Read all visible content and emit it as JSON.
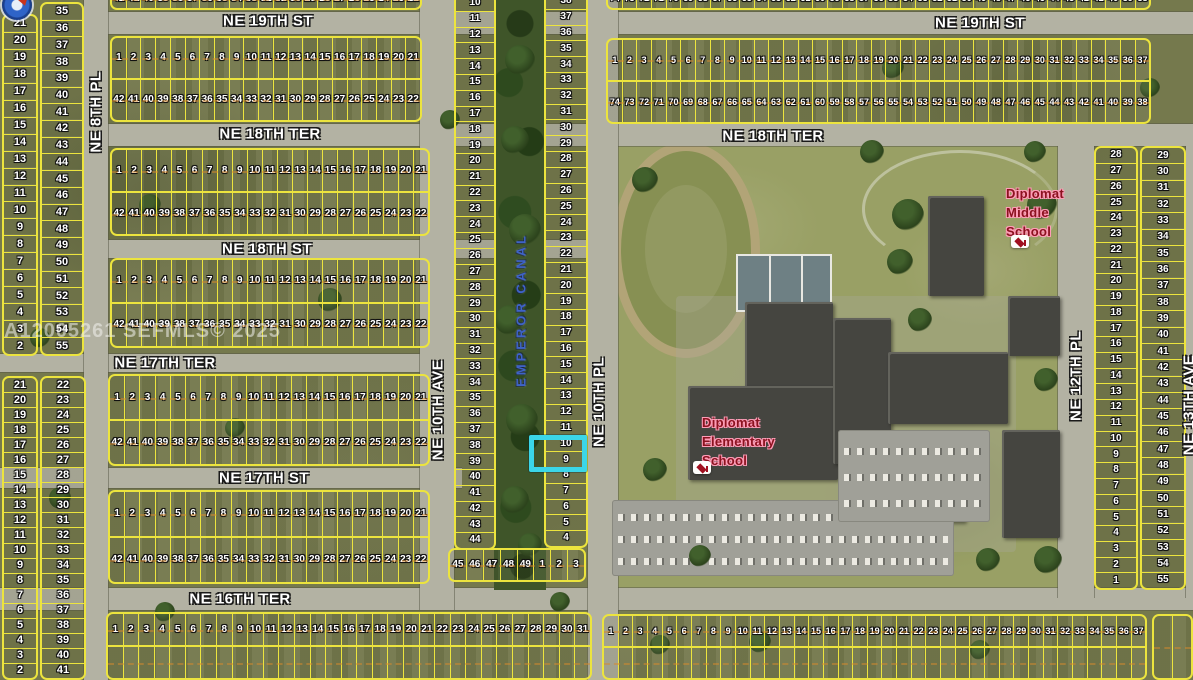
{
  "watermark": "A12005261 SEFMLS© 2025",
  "canal_label": "EMPEROR CANAL",
  "colors": {
    "line": "#ece43e",
    "hl": "#3bd6e8",
    "schoolred": "#8c1220",
    "schoolglow": "#ff9db8",
    "canalblue": "#3e63c8",
    "wm": "rgba(242,242,238,0.55)",
    "road": "#b3b2a3"
  },
  "schools": {
    "elementary": {
      "lines": [
        "Diplomat",
        "Elementary",
        "School"
      ]
    },
    "middle": {
      "lines": [
        "Diplomat",
        "Middle",
        "School"
      ]
    }
  },
  "roads": [
    {
      "id": "ne-19th-st",
      "x": 84,
      "y": 12,
      "w": 1109,
      "h": 22
    },
    {
      "id": "ne-18th-ter",
      "x": 108,
      "y": 124,
      "w": 1085,
      "h": 22
    },
    {
      "id": "ne-18th-st",
      "x": 108,
      "y": 240,
      "w": 510,
      "h": 18
    },
    {
      "id": "ne-17th-ter",
      "x": 0,
      "y": 354,
      "w": 454,
      "h": 18
    },
    {
      "id": "ne-17th-st",
      "x": 0,
      "y": 468,
      "w": 462,
      "h": 20
    },
    {
      "id": "ne-16th-ter",
      "x": 0,
      "y": 588,
      "w": 1193,
      "h": 22
    },
    {
      "id": "ne-8th-pl",
      "x": 84,
      "y": 0,
      "w": 24,
      "h": 680
    },
    {
      "id": "ne-10th-ave",
      "x": 420,
      "y": 0,
      "w": 34,
      "h": 610
    },
    {
      "id": "ne-10th-pl",
      "x": 588,
      "y": 0,
      "w": 30,
      "h": 680
    },
    {
      "id": "ne-12th-pl",
      "x": 1058,
      "y": 146,
      "w": 36,
      "h": 452
    },
    {
      "id": "ne-13th-ave",
      "x": 1186,
      "y": 146,
      "w": 7,
      "h": 452
    }
  ],
  "street_labels": [
    {
      "id": "ne-19th-st-west",
      "text": "NE 19TH ST",
      "x": 268,
      "y": 21,
      "vertical": false
    },
    {
      "id": "ne-19th-st-east",
      "text": "NE 19TH ST",
      "x": 980,
      "y": 23,
      "vertical": false
    },
    {
      "id": "ne-18th-ter-west",
      "text": "NE 18TH TER",
      "x": 270,
      "y": 134,
      "vertical": false
    },
    {
      "id": "ne-18th-ter-east",
      "text": "NE 18TH TER",
      "x": 773,
      "y": 136,
      "vertical": false
    },
    {
      "id": "ne-18th-st",
      "text": "NE 18TH ST",
      "x": 267,
      "y": 249,
      "vertical": false
    },
    {
      "id": "ne-17th-ter",
      "text": "NE 17TH TER",
      "x": 165,
      "y": 363,
      "vertical": false
    },
    {
      "id": "ne-17th-st",
      "text": "NE 17TH ST",
      "x": 264,
      "y": 478,
      "vertical": false
    },
    {
      "id": "ne-16th-ter",
      "text": "NE 16TH TER",
      "x": 240,
      "y": 599,
      "vertical": false
    },
    {
      "id": "ne-8th-pl",
      "text": "NE 8TH PL",
      "x": 96,
      "y": 112,
      "vertical": true
    },
    {
      "id": "ne-10th-ave",
      "text": "NE 10TH AVE",
      "x": 438,
      "y": 410,
      "vertical": true
    },
    {
      "id": "ne-10th-pl",
      "text": "NE 10TH PL",
      "x": 599,
      "y": 402,
      "vertical": true
    },
    {
      "id": "ne-12th-pl",
      "text": "NE 12TH PL",
      "x": 1076,
      "y": 376,
      "vertical": true
    },
    {
      "id": "ne-13th-ave",
      "text": "NE 13TH AVE",
      "x": 1189,
      "y": 405,
      "vertical": true
    }
  ],
  "sequences": {
    "asc1_21": [
      1,
      2,
      3,
      4,
      5,
      6,
      7,
      8,
      9,
      10,
      11,
      12,
      13,
      14,
      15,
      16,
      17,
      18,
      19,
      20,
      21
    ],
    "desc42_22": [
      42,
      41,
      40,
      39,
      38,
      37,
      36,
      35,
      34,
      33,
      32,
      31,
      30,
      29,
      28,
      27,
      26,
      25,
      24,
      23,
      22
    ],
    "desc21_2": [
      21,
      20,
      19,
      18,
      17,
      16,
      15,
      14,
      13,
      12,
      11,
      10,
      9,
      8,
      7,
      6,
      5,
      4,
      3,
      2
    ],
    "asc35_55": [
      35,
      36,
      37,
      38,
      39,
      40,
      41,
      42,
      43,
      44,
      45,
      46,
      47,
      48,
      49,
      50,
      51,
      52,
      53,
      54,
      55
    ],
    "asc22_41": [
      22,
      23,
      24,
      25,
      26,
      27,
      28,
      29,
      30,
      31,
      32,
      33,
      34,
      35,
      36,
      37,
      38,
      39,
      40,
      41
    ],
    "asc1_37": [
      1,
      2,
      3,
      4,
      5,
      6,
      7,
      8,
      9,
      10,
      11,
      12,
      13,
      14,
      15,
      16,
      17,
      18,
      19,
      20,
      21,
      22,
      23,
      24,
      25,
      26,
      27,
      28,
      29,
      30,
      31,
      32,
      33,
      34,
      35,
      36,
      37
    ],
    "desc74_38": [
      74,
      73,
      72,
      71,
      70,
      69,
      68,
      67,
      66,
      65,
      64,
      63,
      62,
      61,
      60,
      59,
      58,
      57,
      56,
      55,
      54,
      53,
      52,
      51,
      50,
      49,
      48,
      47,
      46,
      45,
      44,
      43,
      42,
      41,
      40,
      39,
      38
    ],
    "asc1_31": [
      1,
      2,
      3,
      4,
      5,
      6,
      7,
      8,
      9,
      10,
      11,
      12,
      13,
      14,
      15,
      16,
      17,
      18,
      19,
      20,
      21,
      22,
      23,
      24,
      25,
      26,
      27,
      28,
      29,
      30,
      31
    ],
    "desc28_1": [
      28,
      27,
      26,
      25,
      24,
      23,
      22,
      21,
      20,
      19,
      18,
      17,
      16,
      15,
      14,
      13,
      12,
      11,
      10,
      9,
      8,
      7,
      6,
      5,
      4,
      3,
      2,
      1
    ],
    "asc29_55": [
      29,
      30,
      31,
      32,
      33,
      34,
      35,
      36,
      37,
      38,
      39,
      40,
      41,
      42,
      43,
      44,
      45,
      46,
      47,
      48,
      49,
      50,
      51,
      52,
      53,
      54,
      55
    ],
    "asc10_44": [
      10,
      11,
      12,
      13,
      14,
      15,
      16,
      17,
      18,
      19,
      20,
      21,
      22,
      23,
      24,
      25,
      26,
      27,
      28,
      29,
      30,
      31,
      32,
      33,
      34,
      35,
      36,
      37,
      38,
      39,
      40,
      41,
      42,
      43,
      44
    ],
    "desc38_4": [
      38,
      37,
      36,
      35,
      34,
      33,
      32,
      31,
      30,
      29,
      28,
      27,
      26,
      25,
      24,
      23,
      22,
      21,
      20,
      19,
      18,
      17,
      16,
      15,
      14,
      13,
      12,
      11,
      10,
      9,
      8,
      7,
      6,
      5,
      4
    ],
    "canal_bottom": [
      45,
      46,
      47,
      48,
      49,
      1,
      2,
      3
    ]
  },
  "parcel_blocks": [
    {
      "id": "west-col-1-north",
      "x": 2,
      "y": 14,
      "w": 36,
      "h": 342,
      "kind": "col",
      "cells": "desc21_2",
      "fs": 11
    },
    {
      "id": "west-col-2-north",
      "x": 40,
      "y": 2,
      "w": 44,
      "h": 354,
      "kind": "col",
      "cells": "asc35_55",
      "fs": 11
    },
    {
      "id": "west-col-1-south",
      "x": 2,
      "y": 376,
      "w": 36,
      "h": 304,
      "kind": "col",
      "cells": "desc21_2",
      "fs": 11
    },
    {
      "id": "west-col-2-south",
      "x": 40,
      "y": 376,
      "w": 46,
      "h": 304,
      "kind": "col",
      "cells": "asc22_41",
      "fs": 11
    },
    {
      "id": "block-19th-partial-west",
      "x": 110,
      "y": -12,
      "w": 312,
      "h": 22,
      "kind": "rows",
      "rows": [
        "desc42_22"
      ],
      "fs": 10
    },
    {
      "id": "block-19thst-18thter-west",
      "x": 110,
      "y": 36,
      "w": 312,
      "h": 86,
      "kind": "rows",
      "rows": [
        "asc1_21",
        "desc42_22"
      ],
      "fs": 10
    },
    {
      "id": "block-18thter-18thst",
      "x": 110,
      "y": 148,
      "w": 320,
      "h": 88,
      "kind": "rows",
      "rows": [
        "asc1_21",
        "desc42_22"
      ],
      "fs": 10
    },
    {
      "id": "block-18thst-17thter",
      "x": 110,
      "y": 258,
      "w": 320,
      "h": 90,
      "kind": "rows",
      "rows": [
        "asc1_21",
        "desc42_22"
      ],
      "fs": 10
    },
    {
      "id": "block-17thter-17thst",
      "x": 108,
      "y": 374,
      "w": 322,
      "h": 92,
      "kind": "rows",
      "rows": [
        "asc1_21",
        "desc42_22"
      ],
      "fs": 10
    },
    {
      "id": "block-17thst-16thter",
      "x": 108,
      "y": 490,
      "w": 322,
      "h": 94,
      "kind": "rows",
      "rows": [
        "asc1_21",
        "desc42_22"
      ],
      "fs": 10
    },
    {
      "id": "block-south-of-16thter-west",
      "x": 106,
      "y": 612,
      "w": 486,
      "h": 68,
      "kind": "rows",
      "rows": [
        "asc1_31",
        {
          "empty": 31
        }
      ],
      "fs": 10
    },
    {
      "id": "block-19th-partial-east",
      "x": 606,
      "y": -14,
      "w": 545,
      "h": 24,
      "kind": "rows",
      "rows": [
        "desc74_38"
      ],
      "fs": 9
    },
    {
      "id": "block-19thst-18thter-east",
      "x": 606,
      "y": 38,
      "w": 545,
      "h": 86,
      "kind": "rows",
      "rows": [
        "asc1_37",
        "desc74_38"
      ],
      "fs": 9
    },
    {
      "id": "east-col-1",
      "x": 1094,
      "y": 146,
      "w": 44,
      "h": 444,
      "kind": "col",
      "cells": "desc28_1",
      "fs": 10
    },
    {
      "id": "east-col-2",
      "x": 1140,
      "y": 146,
      "w": 46,
      "h": 444,
      "kind": "col",
      "cells": "asc29_55",
      "fs": 10
    },
    {
      "id": "canal-col-west",
      "x": 454,
      "y": -6,
      "w": 42,
      "h": 556,
      "kind": "col",
      "cells": "asc10_44",
      "fs": 10
    },
    {
      "id": "canal-col-east",
      "x": 544,
      "y": -8,
      "w": 44,
      "h": 556,
      "kind": "col",
      "cells": "desc38_4",
      "fs": 10
    },
    {
      "id": "canal-bottom-row",
      "x": 448,
      "y": 548,
      "w": 138,
      "h": 34,
      "kind": "rows",
      "rows": [
        "canal_bottom"
      ],
      "fs": 10
    },
    {
      "id": "block-south-of-16thter-east",
      "x": 602,
      "y": 614,
      "w": 545,
      "h": 66,
      "kind": "rows",
      "rows": [
        "asc1_37",
        {
          "empty": 37
        }
      ],
      "fs": 9
    },
    {
      "id": "corner-block-se",
      "x": 1152,
      "y": 614,
      "w": 41,
      "h": 66,
      "kind": "rows",
      "rows": [
        {
          "empty": 2
        }
      ],
      "fs": 9
    }
  ],
  "school_area": {
    "buildings": [
      {
        "x": 745,
        "y": 302,
        "w": 88,
        "h": 120
      },
      {
        "x": 688,
        "y": 386,
        "w": 150,
        "h": 94
      },
      {
        "x": 833,
        "y": 318,
        "w": 58,
        "h": 146
      },
      {
        "x": 888,
        "y": 352,
        "w": 120,
        "h": 72
      },
      {
        "x": 928,
        "y": 196,
        "w": 56,
        "h": 100
      },
      {
        "x": 1002,
        "y": 430,
        "w": 58,
        "h": 108
      },
      {
        "x": 1008,
        "y": 296,
        "w": 52,
        "h": 60
      },
      {
        "x": 905,
        "y": 452,
        "w": 60,
        "h": 70
      }
    ],
    "parking_lots": [
      {
        "x": 612,
        "y": 500,
        "w": 342,
        "h": 76,
        "rows": [
          14,
          36,
          58
        ]
      },
      {
        "x": 838,
        "y": 430,
        "w": 152,
        "h": 92,
        "rows": [
          18,
          44,
          70
        ]
      }
    ]
  },
  "trees": [
    {
      "x": 520,
      "y": 60,
      "r": 15
    },
    {
      "x": 515,
      "y": 140,
      "r": 14
    },
    {
      "x": 525,
      "y": 230,
      "r": 16
    },
    {
      "x": 510,
      "y": 320,
      "r": 15
    },
    {
      "x": 522,
      "y": 420,
      "r": 16
    },
    {
      "x": 515,
      "y": 500,
      "r": 14
    },
    {
      "x": 530,
      "y": 545,
      "r": 12
    },
    {
      "x": 908,
      "y": 215,
      "r": 16
    },
    {
      "x": 900,
      "y": 262,
      "r": 13
    },
    {
      "x": 872,
      "y": 152,
      "r": 12
    },
    {
      "x": 1042,
      "y": 205,
      "r": 15
    },
    {
      "x": 1046,
      "y": 380,
      "r": 12
    },
    {
      "x": 1048,
      "y": 560,
      "r": 14
    },
    {
      "x": 700,
      "y": 556,
      "r": 11
    },
    {
      "x": 645,
      "y": 180,
      "r": 13
    },
    {
      "x": 655,
      "y": 470,
      "r": 12
    },
    {
      "x": 988,
      "y": 560,
      "r": 12
    },
    {
      "x": 1035,
      "y": 152,
      "r": 11
    },
    {
      "x": 920,
      "y": 320,
      "r": 12
    },
    {
      "x": 150,
      "y": 205,
      "r": 11
    },
    {
      "x": 330,
      "y": 300,
      "r": 12
    },
    {
      "x": 235,
      "y": 428,
      "r": 10
    },
    {
      "x": 60,
      "y": 498,
      "r": 11
    },
    {
      "x": 165,
      "y": 612,
      "r": 10
    },
    {
      "x": 893,
      "y": 68,
      "r": 11
    },
    {
      "x": 1150,
      "y": 88,
      "r": 10
    },
    {
      "x": 450,
      "y": 120,
      "r": 10
    },
    {
      "x": 40,
      "y": 338,
      "r": 10
    },
    {
      "x": 560,
      "y": 602,
      "r": 10
    },
    {
      "x": 760,
      "y": 642,
      "r": 11
    },
    {
      "x": 980,
      "y": 650,
      "r": 10
    },
    {
      "x": 660,
      "y": 645,
      "r": 10
    }
  ]
}
